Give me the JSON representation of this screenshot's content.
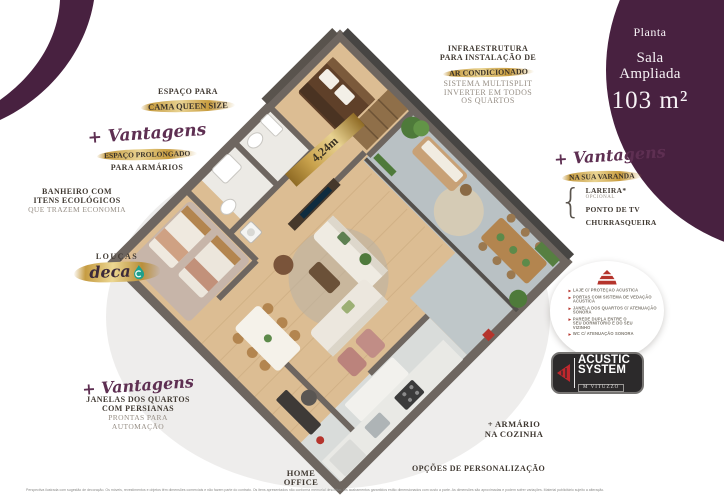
{
  "colors": {
    "purple": "#482140",
    "script_purple": "#5e2f52",
    "gold": "#c89c3e",
    "text_dark": "#403932",
    "text_light": "#978f86",
    "red_accent": "#b5342c",
    "wall_gray": "#6e6660",
    "wood_floor": "#dcbd93",
    "terrace_tile": "#b9c1c4"
  },
  "badge": {
    "kicker": "Planta",
    "title_line1": "Sala",
    "title_line2": "Ampliada",
    "area": "103 m²"
  },
  "annotations": {
    "queen": {
      "line1": "ESPAÇO PARA",
      "highlight": "CAMA QUEEN SIZE"
    },
    "armarios": {
      "script": "+ Vantagens",
      "highlight": "ESPAÇO PROLONGADO",
      "line2": "PARA ARMÁRIOS"
    },
    "banheiro": {
      "line1": "BANHEIRO COM",
      "line2": "ITENS ECOLÓGICOS",
      "line3": "QUE TRAZEM ECONOMIA"
    },
    "loucas": {
      "label": "LOUÇAS",
      "brand": "deca"
    },
    "ar_condicionado": {
      "line1": "INFRAESTRUTURA",
      "line2": "PARA INSTALAÇÃO DE",
      "highlight": "AR CONDICIONADO",
      "line4": "SISTEMA MULTISPLIT",
      "line5": "INVERTER EM TODOS",
      "line6": "OS QUARTOS"
    },
    "varanda": {
      "script": "+ Vantagens",
      "highlight": "NA SUA VARANDA",
      "brace": "{",
      "items": [
        {
          "label": "LAREIRA*",
          "sub": "OPCIONAL"
        },
        {
          "label": "PONTO DE TV",
          "sub": ""
        },
        {
          "label": "CHURRASQUEIRA",
          "sub": ""
        }
      ]
    },
    "acoustic": {
      "features": [
        "LAJE C/ PROTEÇÃO ACÚSTICA",
        "PORTAS COM SISTEMA DE VEDAÇÃO ACÚSTICA",
        "JANELA DOS QUARTOS C/ ATENUAÇÃO SONORA",
        "PAREDE DUPLA ENTRE O SEU DORMITÓRIO E DO SEU VIZINHO",
        "WC C/ ATENUAÇÃO SONORA"
      ],
      "logo_line1": "ACUSTIC",
      "logo_line2": "SYSTEM",
      "logo_brand": "M VITUZZO"
    },
    "janelas": {
      "script": "+ Vantagens",
      "line1": "JANELAS DOS QUARTOS",
      "line2": "COM PERSIANAS",
      "line3": "PRONTAS PARA",
      "line4": "AUTOMAÇÃO"
    },
    "armario_cozinha": {
      "line1": "+ ARMÁRIO",
      "line2": "NA COZINHA"
    },
    "personalizacao": {
      "label": "OPÇÕES DE PERSONALIZAÇÃO"
    },
    "home_office": {
      "line1": "HOME",
      "line2": "OFFICE"
    },
    "plan": {
      "measurement": "4,24m"
    }
  },
  "disclaimer": {
    "text": "Perspectiva ilustrada com sugestão de decoração. Os móveis, revestimentos e objetos têm dimensões comerciais e não fazem parte do contrato. Os itens apresentados não conforma memorial descritivo. Os acabamentos garantidos estão dimensionados com custo a parte. As dimensões são aproximadas e podem sofrer variações. Material publicitário sujeito a alteração."
  }
}
